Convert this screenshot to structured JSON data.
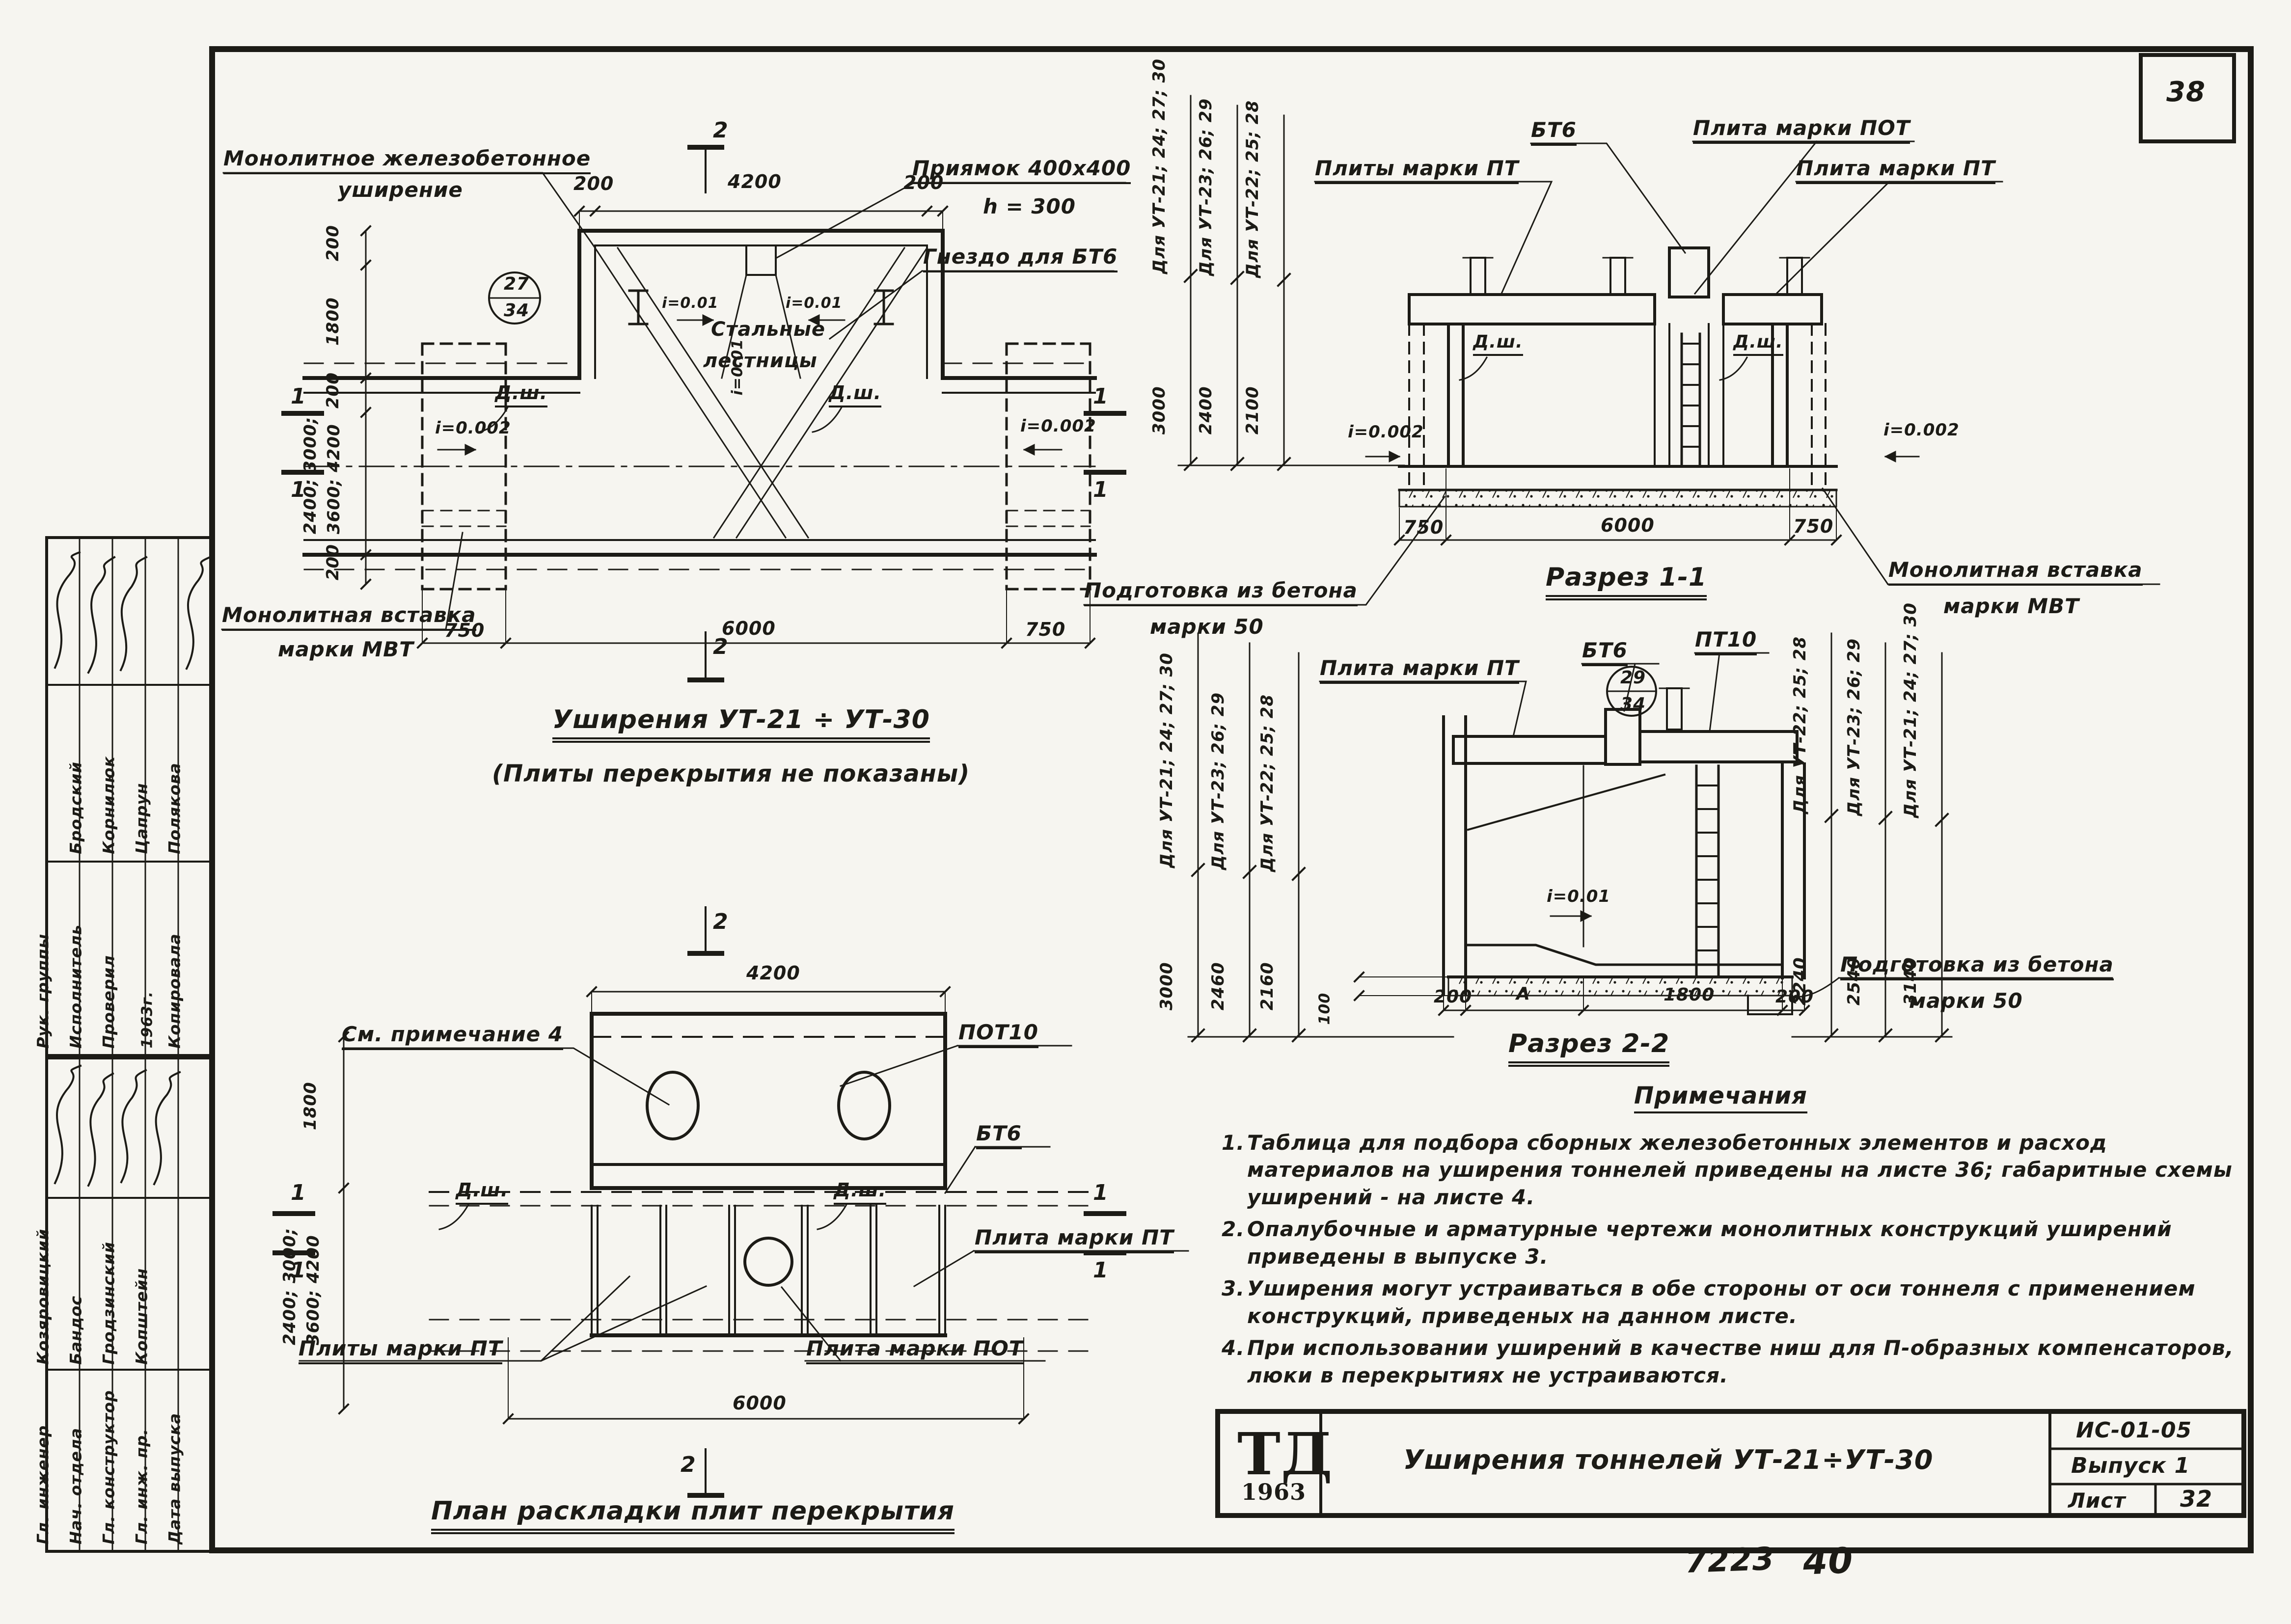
{
  "colors": {
    "paper": "#f6f5f0",
    "ink": "#1c1b16"
  },
  "page": {
    "sheet_corner_number": "38",
    "stamp_number_1": "7223",
    "stamp_number_2": "40"
  },
  "title_block": {
    "logo_top": "ТД",
    "logo_year": "1963",
    "title": "Уширения тоннелей УТ-21÷УТ-30",
    "code": "ИС-01-05",
    "issue": "Выпуск 1",
    "sheet_label": "Лист",
    "sheet_number": "32"
  },
  "sidebar": {
    "block_a": {
      "rows": [
        {
          "role": "Рук. группы",
          "name": "Бродский"
        },
        {
          "role": "Исполнитель",
          "name": "Корнилюк"
        },
        {
          "role": "Проверил",
          "name": "Цапрун"
        },
        {
          "role": "",
          "name": ""
        },
        {
          "role": "Копировала",
          "name": "Полякова"
        }
      ],
      "year": "1963г."
    },
    "block_b": {
      "rows": [
        {
          "role": "Гл. инженер",
          "name": "Козяровицкий"
        },
        {
          "role": "Нач. отдела",
          "name": "Бандос"
        },
        {
          "role": "Гл. конструктор",
          "name": "Гродзинский"
        },
        {
          "role": "Гл. инж. пр.",
          "name": "Копштейн"
        },
        {
          "role": "Дата выпуска",
          "name": ""
        }
      ]
    }
  },
  "fig_plan": {
    "callout_monolithic_1": "Монолитное железобетонное",
    "callout_monolithic_2": "уширение",
    "callout_pit_1": "Приямок 400х400",
    "callout_pit_2": "h = 300",
    "callout_socket": "Гнездо для БТ6",
    "label_stairs_1": "Стальные",
    "label_stairs_2": "лестницы",
    "ref_top": "27",
    "ref_bottom": "34",
    "slope_inner": "i=0.01",
    "slope_side": "i=0.002",
    "joint": "Д.ш.",
    "dim_top_left": "200",
    "dim_top_mid": "4200",
    "dim_top_right": "200",
    "dim_left_1": "200",
    "dim_left_2": "1800",
    "dim_left_3": "200",
    "dim_left_var_1": "2400; 3000;",
    "dim_left_var_2": "3600; 4200",
    "dim_left_4": "200",
    "dim_bottom_left": "750",
    "dim_bottom_mid": "6000",
    "dim_bottom_right": "750",
    "callout_insert_1": "Монолитная вставка",
    "callout_insert_2": "марки МВТ",
    "mark_1": "1",
    "mark_2": "2",
    "title": "Уширения УТ-21 ÷ УТ-30",
    "subtitle": "(Плиты перекрытия не показаны)"
  },
  "fig_slab_plan": {
    "callout_note": "См. примечание 4",
    "label_pot10": "ПОТ10",
    "label_bt6": "БТ6",
    "label_pt": "Плита марки ПТ",
    "label_pt_plural": "Плиты марки ПТ",
    "label_pot": "Плита марки ПОТ",
    "joint": "Д.ш.",
    "dim_top": "4200",
    "dim_left": "1800",
    "dim_left_var_1": "2400; 3000;",
    "dim_left_var_2": "3600; 4200",
    "dim_bottom": "6000",
    "mark_1": "1",
    "mark_2": "2",
    "title": "План раскладки плит перекрытия"
  },
  "fig_section_1": {
    "title": "Разрез 1-1",
    "group_1": "Для УТ-21; 24; 27; 30",
    "group_2": "Для УТ-23; 26; 29",
    "group_3": "Для УТ-22; 25; 28",
    "height_1": "3000",
    "height_2": "2400",
    "height_3": "2100",
    "label_pt_plural": "Плиты марки ПТ",
    "label_bt6": "БТ6",
    "label_pot": "Плита марки ПОТ",
    "label_pt": "Плита марки ПТ",
    "joint": "Д.ш.",
    "slope_side": "i=0.002",
    "callout_prep_1": "Подготовка из бетона",
    "callout_prep_2": "марки 50",
    "callout_insert_1": "Монолитная вставка",
    "callout_insert_2": "марки МВТ",
    "dim_left": "750",
    "dim_mid": "6000",
    "dim_right": "750"
  },
  "fig_section_2": {
    "title": "Разрез 2-2",
    "group_left_1": "Для УТ-21; 24; 27; 30",
    "group_left_2": "Для УТ-23; 26; 29",
    "group_left_3": "Для УТ-22; 25; 28",
    "height_left_1": "3000",
    "height_left_2": "2460",
    "height_left_3": "2160",
    "group_right_1": "Для УТ-22; 25; 28",
    "group_right_2": "Для УТ-23; 26; 29",
    "group_right_3": "Для УТ-21; 24; 27; 30",
    "height_right_1": "2240",
    "height_right_2": "2540",
    "height_right_3": "3140",
    "label_pt": "Плита марки ПТ",
    "label_bt6": "БТ6",
    "label_pt10": "ПТ10",
    "ref_top": "29",
    "ref_bottom": "34",
    "slope_floor": "i=0.01",
    "dim_thickness": "100",
    "dim_1": "200",
    "dim_2": "А",
    "dim_3": "1800",
    "dim_4": "200",
    "callout_prep_1": "Подготовка из бетона",
    "callout_prep_2": "марки 50"
  },
  "notes": {
    "title": "Примечания",
    "items": [
      {
        "num": "1.",
        "text": "Таблица для подбора сборных железобетонных элементов и расход материалов на уширения тоннелей приведены на листе 36; габаритные схемы уширений - на листе 4."
      },
      {
        "num": "2.",
        "text": "Опалубочные и арматурные чертежи монолитных конструкций уширений приведены в выпуске 3."
      },
      {
        "num": "3.",
        "text": "Уширения могут устраиваться в обе стороны от оси тоннеля с применением конструкций, приведеных на данном листе."
      },
      {
        "num": "4.",
        "text": "При использовании уширений в качестве ниш для П-образных компенсаторов, люки в перекрытиях не устраиваются."
      }
    ]
  }
}
